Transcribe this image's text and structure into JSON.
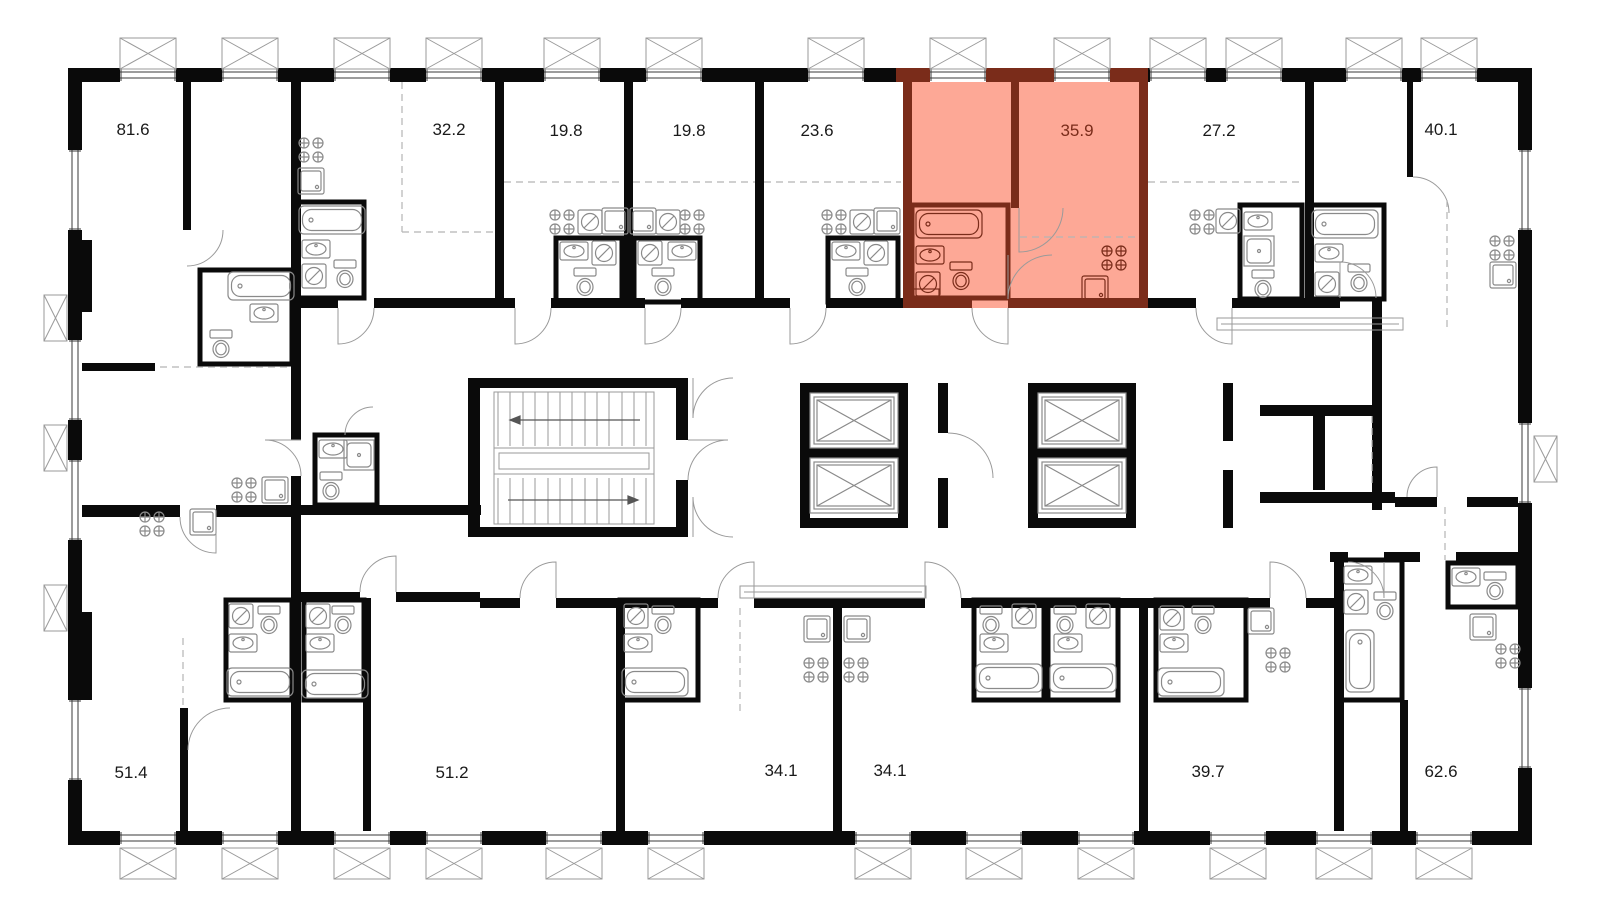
{
  "plan": {
    "type": "residential-floor-plan",
    "colors": {
      "background": "#ffffff",
      "wall": "#0a0a0a",
      "highlight_fill": "#fda896",
      "highlight_wall": "#7a2c1a",
      "highlight_text": "#7a2c1a",
      "fixture_stroke": "#8a8a8a",
      "dashed": "#b5b5b5",
      "door_arc": "#9a9a9a",
      "balcony_stroke": "#9a9a9a",
      "label_text": "#1a1a1a"
    },
    "apartments": [
      {
        "id": "81-6",
        "area": "81.6",
        "row": "top",
        "highlighted": false
      },
      {
        "id": "32-2",
        "area": "32.2",
        "row": "top",
        "highlighted": false
      },
      {
        "id": "19-8-a",
        "area": "19.8",
        "row": "top",
        "highlighted": false
      },
      {
        "id": "19-8-b",
        "area": "19.8",
        "row": "top",
        "highlighted": false
      },
      {
        "id": "23-6",
        "area": "23.6",
        "row": "top",
        "highlighted": false
      },
      {
        "id": "35-9",
        "area": "35.9",
        "row": "top",
        "highlighted": true
      },
      {
        "id": "27-2",
        "area": "27.2",
        "row": "top",
        "highlighted": false
      },
      {
        "id": "40-1",
        "area": "40.1",
        "row": "top",
        "highlighted": false
      },
      {
        "id": "51-4",
        "area": "51.4",
        "row": "bottom",
        "highlighted": false
      },
      {
        "id": "51-2",
        "area": "51.2",
        "row": "bottom",
        "highlighted": false
      },
      {
        "id": "34-1-a",
        "area": "34.1",
        "row": "bottom",
        "highlighted": false
      },
      {
        "id": "34-1-b",
        "area": "34.1",
        "row": "bottom",
        "highlighted": false
      },
      {
        "id": "39-7",
        "area": "39.7",
        "row": "bottom",
        "highlighted": false
      },
      {
        "id": "62-6",
        "area": "62.6",
        "row": "bottom",
        "highlighted": false
      }
    ],
    "icons": {
      "stove-icon": "2x2 gas burners (crossed circles)",
      "sink-icon": "square basin with corner drain dot",
      "cooktop-washer-icon": "square with slashed circle",
      "bathtub-icon": "rounded tub with drain",
      "toilet-icon": "tank and bowl",
      "washbasin-icon": "rect with oval bowl",
      "shower-icon": "square tray",
      "elevator-icon": "shaft box with X",
      "stairs-icon": "treads with landing and direction arrows",
      "window-icon": "double glazing lines in wall",
      "balcony-icon": "crossed rectangle outside wall"
    }
  }
}
